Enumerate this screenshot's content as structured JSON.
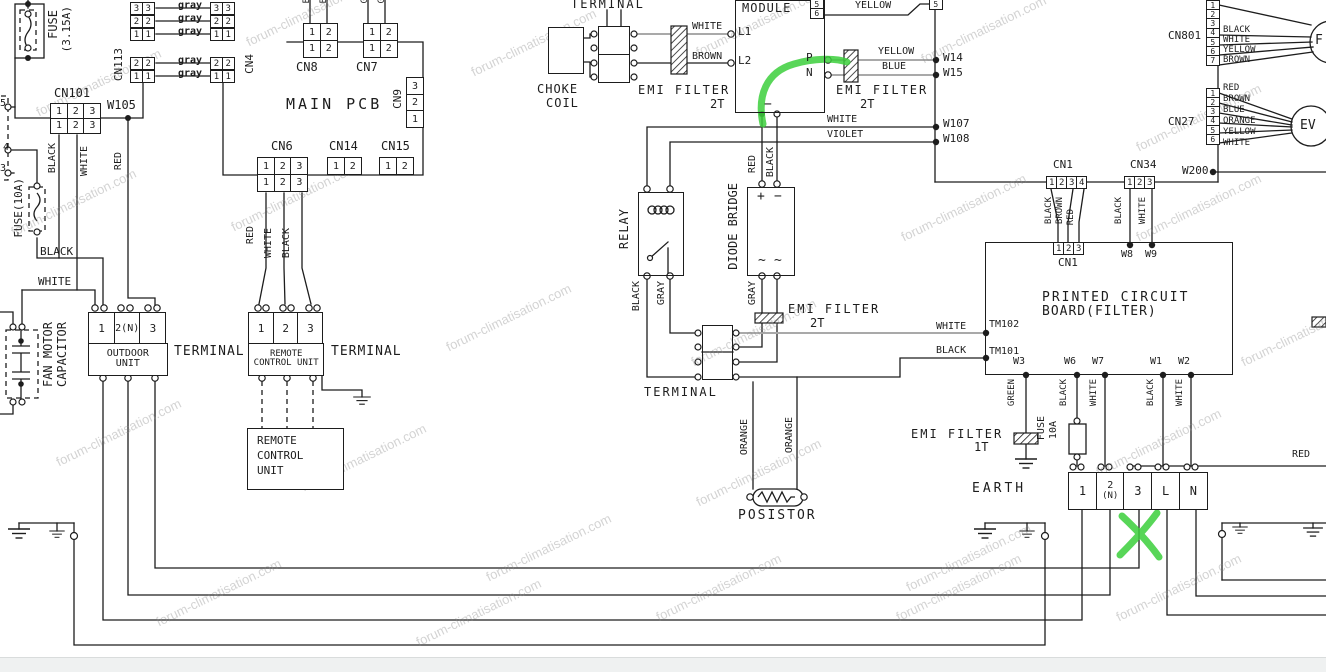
{
  "watermark": "forum-climatisation.com",
  "w": {
    "black": "BLACK",
    "white": "WHITE",
    "red": "RED",
    "brown": "BROWN",
    "yellow": "YELLOW",
    "blue": "BLUE",
    "violet": "VIOLET",
    "gray": "GRAY",
    "green": "GREEN",
    "orange": "ORANGE",
    "graylc": "gray",
    "b": "B",
    "g": "G"
  },
  "d": {
    "n1": "1",
    "n2": "2",
    "n3": "3",
    "n4": "4",
    "n5": "5",
    "n6": "6",
    "n7": "7",
    "l": "L",
    "n": "N",
    "n2p": "2(N)",
    "np": "(N)"
  },
  "comp": {
    "fuse315a": "FUSE",
    "fuse315b": "(3.15A)",
    "fuse10": "FUSE(10A)",
    "fuse": "FUSE",
    "amp10": "10A",
    "cn101": "CN101",
    "cn113": "CN113",
    "cn4": "CN4",
    "w105": "W105",
    "fan1": "FAN MOTOR",
    "fan2": "CAPACITOR",
    "mainpcb": "MAIN PCB",
    "cn8": "CN8",
    "cn7": "CN7",
    "cn9": "CN9",
    "cn6": "CN6",
    "cn14": "CN14",
    "cn15": "CN15",
    "outdoor1": "OUTDOOR",
    "outdoor2": "UNIT",
    "terminal": "TERMINAL",
    "remote1": "REMOTE",
    "remote2": "CONTROL UNIT",
    "rc1": "REMOTE",
    "rc2": "CONTROL",
    "rc3": "UNIT",
    "choke1": "CHOKE",
    "choke2": "COIL",
    "emi": "EMI FILTER",
    "t2": "2T",
    "t1": "1T",
    "module": "MODULE",
    "l1": "L1",
    "l2": "L2",
    "p": "P",
    "n": "N",
    "minus": "−",
    "plus": "+",
    "tilde": "~",
    "relay": "RELAY",
    "diode": "DIODE BRIDGE",
    "posistor": "POSISTOR",
    "w14": "W14",
    "w15": "W15",
    "w107": "W107",
    "w108": "W108",
    "w200": "W200",
    "cn1": "CN1",
    "cn34": "CN34",
    "w8": "W8",
    "w9": "W9",
    "pcbf1": "PRINTED CIRCUIT",
    "pcbf2": "BOARD(FILTER)",
    "tm102": "TM102",
    "tm101": "TM101",
    "w3": "W3",
    "w6": "W6",
    "w7": "W7",
    "w1": "W1",
    "w2": "W2",
    "earth": "EARTH",
    "cn801": "CN801",
    "cn27": "CN27",
    "f": "F",
    "ev": "EV"
  },
  "annotation": {
    "green": "#3ccf3c"
  }
}
